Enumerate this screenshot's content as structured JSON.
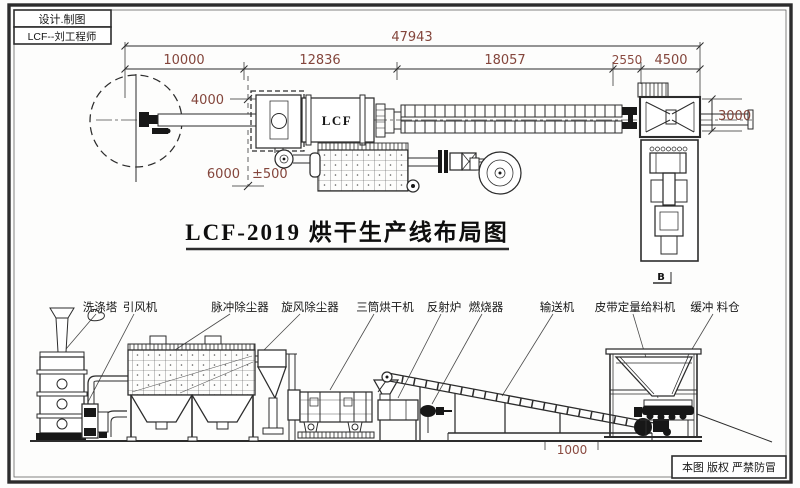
{
  "title_block": {
    "design": "设计.制图",
    "engineer": "LCF--刘工程师"
  },
  "drawing_title": "LCF-2019  烘干生产线布局图",
  "dimensions": {
    "overall": "47943",
    "segments": [
      "10000",
      "12836",
      "18057",
      "2550",
      "4500"
    ],
    "height_upper": "4000",
    "height_lower": "6000",
    "tolerance": "±500",
    "hopper_height": "3000",
    "platform_offset": "1000"
  },
  "plan_view": {
    "dryer_label": "LCF",
    "section_marker": "B"
  },
  "equipment_labels": [
    "洗涤塔",
    "引风机",
    "脉冲除尘器",
    "旋风除尘器",
    "三筒烘干机",
    "反射炉",
    "燃烧器",
    "输送机",
    "皮带定量给料机",
    "缓冲 料仓"
  ],
  "copyright_notice": "本图 版权 严禁防冒",
  "colors": {
    "line": "#2c2c2c",
    "dimension_text": "#8a4a40",
    "label_text": "#171717"
  }
}
